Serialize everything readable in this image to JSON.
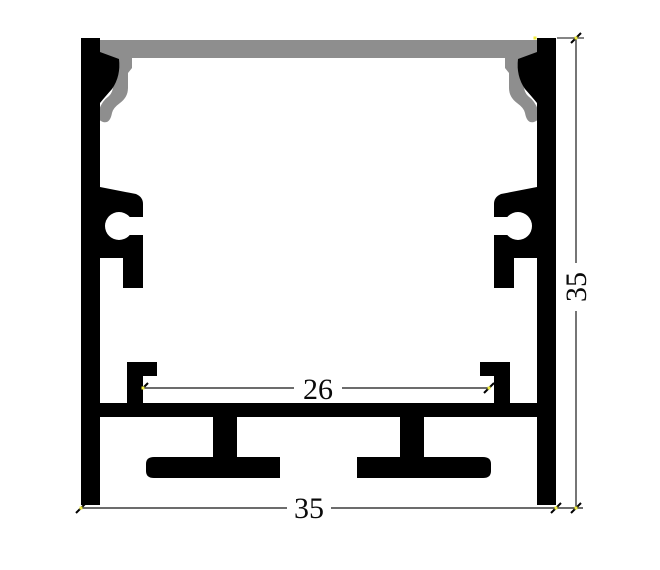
{
  "dimensions": {
    "inner_width": {
      "value": "26"
    },
    "outer_width": {
      "value": "35"
    },
    "overall_height": {
      "value": "35"
    }
  },
  "colors": {
    "profile_fill": "#000000",
    "cover_fill": "#8e8e8e",
    "dimension_line": "#3c3c3c",
    "endpoint_marker": "#f0ec3d",
    "background": "#ffffff"
  }
}
